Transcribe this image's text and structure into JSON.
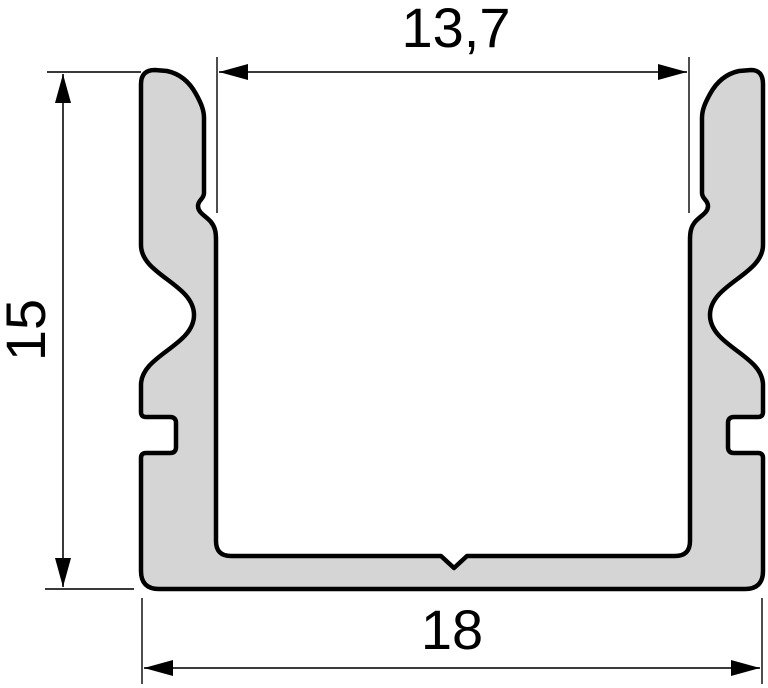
{
  "drawing": {
    "type": "technical-cross-section",
    "subject": "u-shaped-aluminium-profile",
    "background_color": "#ffffff",
    "profile_fill_color": "#d5d5d5",
    "profile_outline_color": "#000000",
    "dimension_line_color": "#3a3a3a",
    "text_color": "#000000",
    "dimensions": {
      "inner_width": {
        "label": "13,7",
        "position": "top"
      },
      "height": {
        "label": "15",
        "position": "left",
        "orientation": "rotated-90"
      },
      "outer_width": {
        "label": "18",
        "position": "bottom"
      }
    }
  }
}
